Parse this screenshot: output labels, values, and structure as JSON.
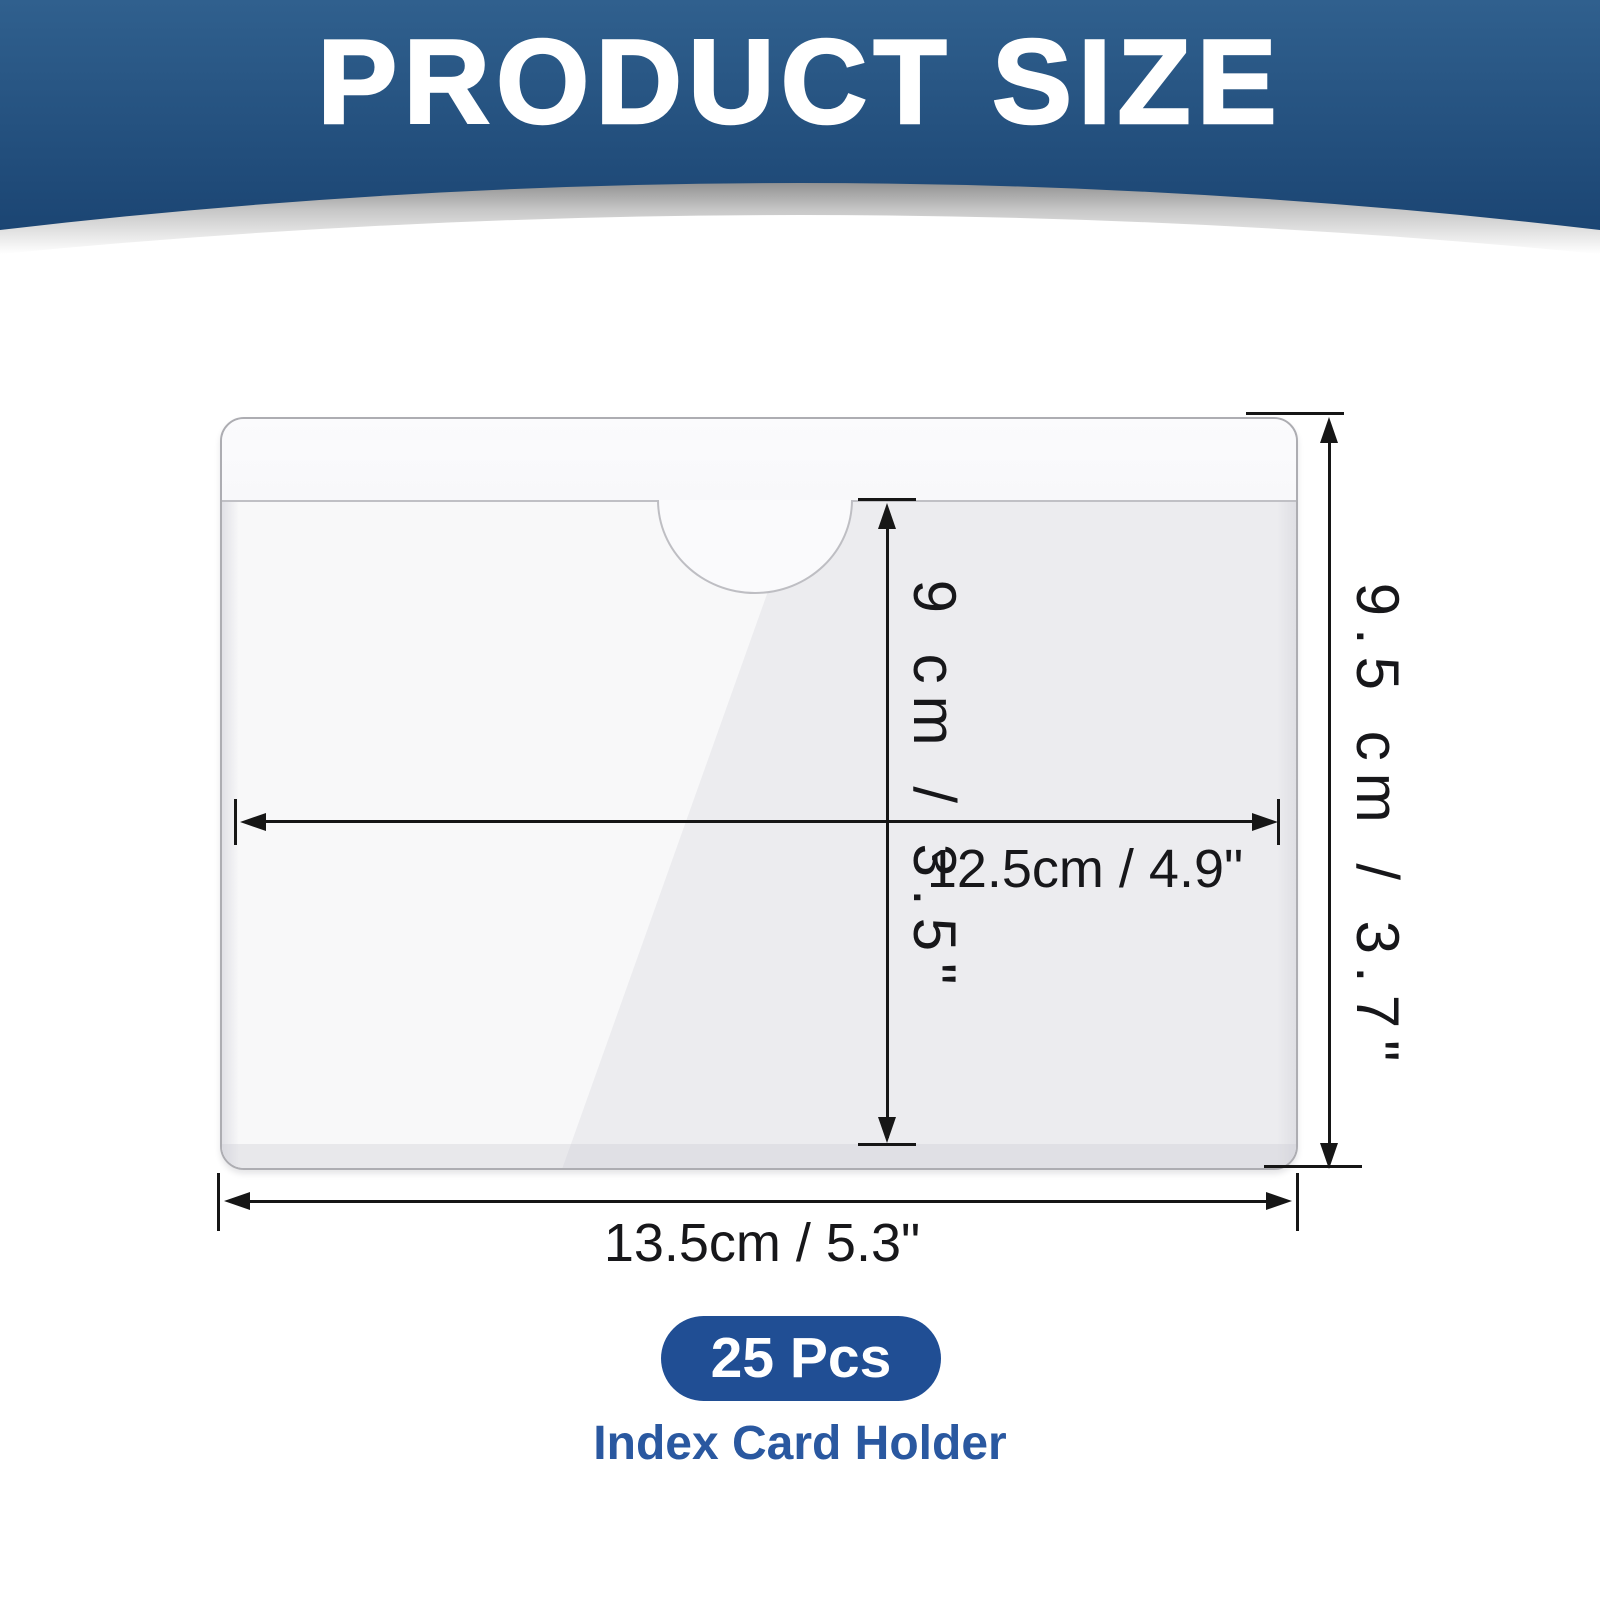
{
  "header": {
    "title": "PRODUCT SIZE"
  },
  "dimensions": {
    "pocket_height": "9 cm / 3.5\"",
    "overall_height": "9.5 cm / 3.7\"",
    "pocket_width": "12.5cm / 4.9\"",
    "overall_width": "13.5cm / 5.3\""
  },
  "footer": {
    "quantity": "25 Pcs",
    "product_name": "Index Card Holder"
  },
  "colors": {
    "header_gradient_top": "#30608E",
    "header_gradient_bottom": "#1B4573",
    "silver_band": "#C6C6C6",
    "badge_background": "#204E94",
    "product_name_text": "#2A58A0",
    "dimension_ink": "#161616"
  }
}
